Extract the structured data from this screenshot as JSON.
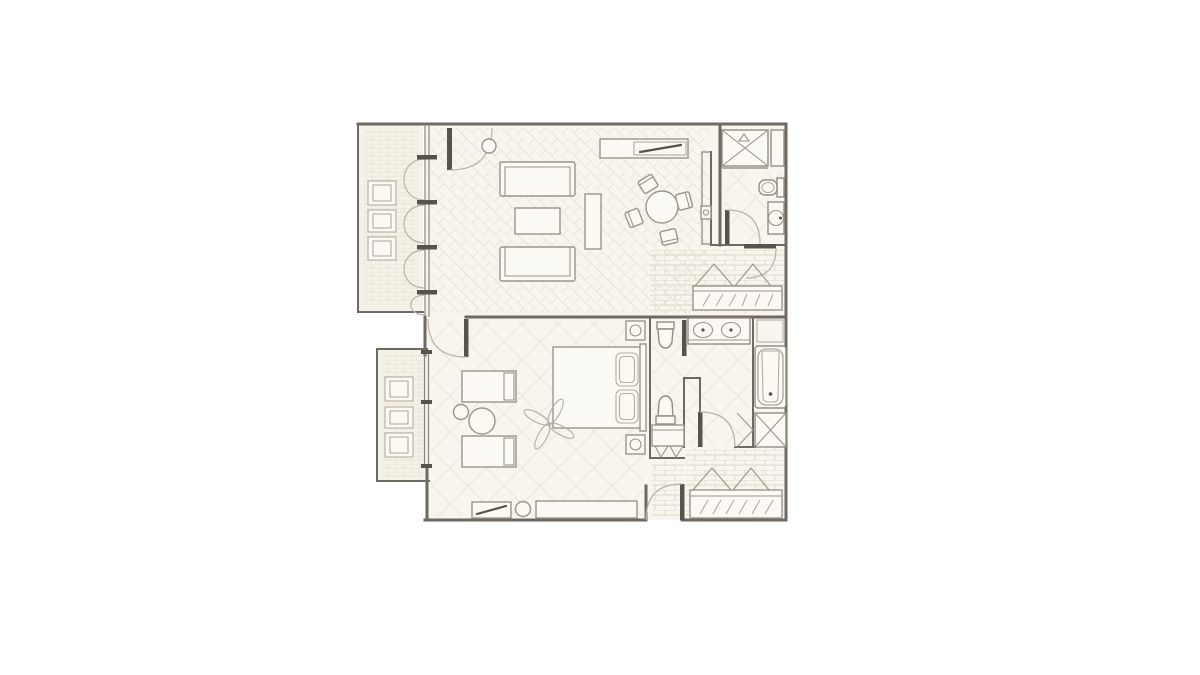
{
  "app": {
    "title": "Hotel suite floor plan",
    "visible_text": ""
  },
  "palette": {
    "background": "#ffffff",
    "floor": "#f8f5ee",
    "terrace_floor": "#f4f1e8",
    "wall": "#6e6962",
    "furniture_line": "#9b9488",
    "pattern_line": "#e8e4d6",
    "accent_dark": "#57524a"
  },
  "plan": {
    "type": "floor-plan",
    "rooms": [
      {
        "id": "living-room",
        "floor_pattern": "herringbone",
        "furniture": [
          "sofa",
          "sofa",
          "coffee-table",
          "side-console",
          "tv-sideboard",
          "round-dining-table",
          "dining-chair",
          "dining-chair",
          "dining-chair",
          "dining-chair",
          "plant",
          "wall-fixture"
        ]
      },
      {
        "id": "upper-terrace",
        "floor_pattern": "brick",
        "furniture": [
          "outdoor-chair",
          "outdoor-chair",
          "outdoor-chair"
        ],
        "doors": [
          "french-door",
          "french-door"
        ]
      },
      {
        "id": "powder-room",
        "floor_pattern": "diamond",
        "furniture": [
          "shower-stall",
          "shelf-cabinet",
          "toilet",
          "sink-vanity"
        ]
      },
      {
        "id": "hallway",
        "floor_pattern": "brick",
        "furniture": [
          "hanger-rack",
          "luggage-bench"
        ]
      },
      {
        "id": "bedroom",
        "floor_pattern": "diamond",
        "furniture": [
          "double-bed",
          "nightstand-with-lamp",
          "nightstand-with-lamp",
          "ceiling-fan",
          "chaise-bench",
          "chaise-bench",
          "round-side-table",
          "round-side-table",
          "tv-cabinet",
          "stool",
          "dresser"
        ]
      },
      {
        "id": "lower-terrace",
        "floor_pattern": "brick",
        "furniture": [
          "outdoor-chair",
          "outdoor-chair",
          "outdoor-chair"
        ]
      },
      {
        "id": "water-closet",
        "floor_pattern": "diamond",
        "furniture": [
          "toilet",
          "bidet",
          "shelf-with-hooks"
        ]
      },
      {
        "id": "bathroom",
        "floor_pattern": "diamond",
        "furniture": [
          "double-sink-vanity",
          "bathtub",
          "shower",
          "towel-shelf"
        ]
      },
      {
        "id": "entry-hall",
        "floor_pattern": "brick",
        "furniture": [
          "hanger-rack",
          "luggage-bench"
        ],
        "doors": [
          "entry-door"
        ]
      }
    ]
  }
}
